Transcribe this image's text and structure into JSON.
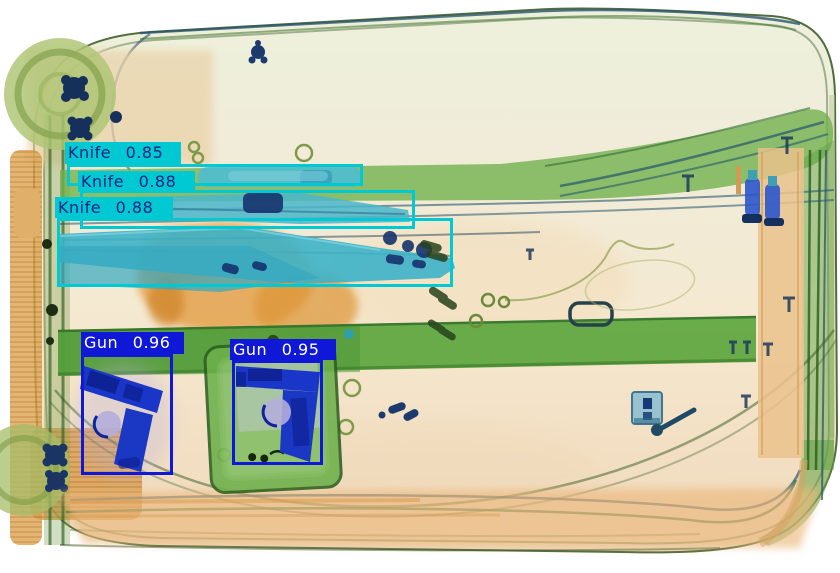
{
  "scene": {
    "kind_label": "xray-baggage-scan",
    "palette": {
      "background": "#ffffff",
      "shell_cream": "#f2e9d3",
      "shell_green_tint": "#ecf0da",
      "strap_green": "#5ca63e",
      "organic_orange": "#e29a3e",
      "metal_blue": "#1936c8",
      "knife_teal": "#41b4c9",
      "wheel_olive": "#adc573"
    }
  },
  "overlay_colors": {
    "knife_box": "#00c9d4",
    "knife_text": "#0a2580",
    "gun_box": "#1018d8",
    "gun_text": "#ffffff"
  },
  "detections": [
    {
      "label": "Knife",
      "score": "0.85",
      "display": "Knife 0.85",
      "color": "#00c9d4",
      "text_color": "#0a2580",
      "box": {
        "x": 67,
        "y": 164,
        "w": 296,
        "h": 22
      },
      "label_box": {
        "x": 65,
        "y": 142,
        "w": 113,
        "h": 22
      }
    },
    {
      "label": "Knife",
      "score": "0.88",
      "display": "Knife 0.88",
      "color": "#00c9d4",
      "text_color": "#0a2580",
      "box": {
        "x": 80,
        "y": 190,
        "w": 335,
        "h": 39
      },
      "label_box": {
        "x": 78,
        "y": 171,
        "w": 114,
        "h": 21
      }
    },
    {
      "label": "Knife",
      "score": "0.88",
      "display": "Knife 0.88",
      "color": "#00c9d4",
      "text_color": "#0a2580",
      "box": {
        "x": 57,
        "y": 218,
        "w": 396,
        "h": 69
      },
      "label_box": {
        "x": 55,
        "y": 197,
        "w": 115,
        "h": 21
      }
    },
    {
      "label": "Gun",
      "score": "0.96",
      "display": "Gun 0.96",
      "color": "#1018d8",
      "text_color": "#ffffff",
      "box": {
        "x": 81,
        "y": 354,
        "w": 92,
        "h": 121
      },
      "label_box": {
        "x": 81,
        "y": 332,
        "w": 100,
        "h": 22
      }
    },
    {
      "label": "Gun",
      "score": "0.95",
      "display": "Gun 0.95",
      "color": "#1018d8",
      "text_color": "#ffffff",
      "box": {
        "x": 232,
        "y": 360,
        "w": 91,
        "h": 105
      },
      "label_box": {
        "x": 230,
        "y": 339,
        "w": 103,
        "h": 21
      }
    }
  ]
}
